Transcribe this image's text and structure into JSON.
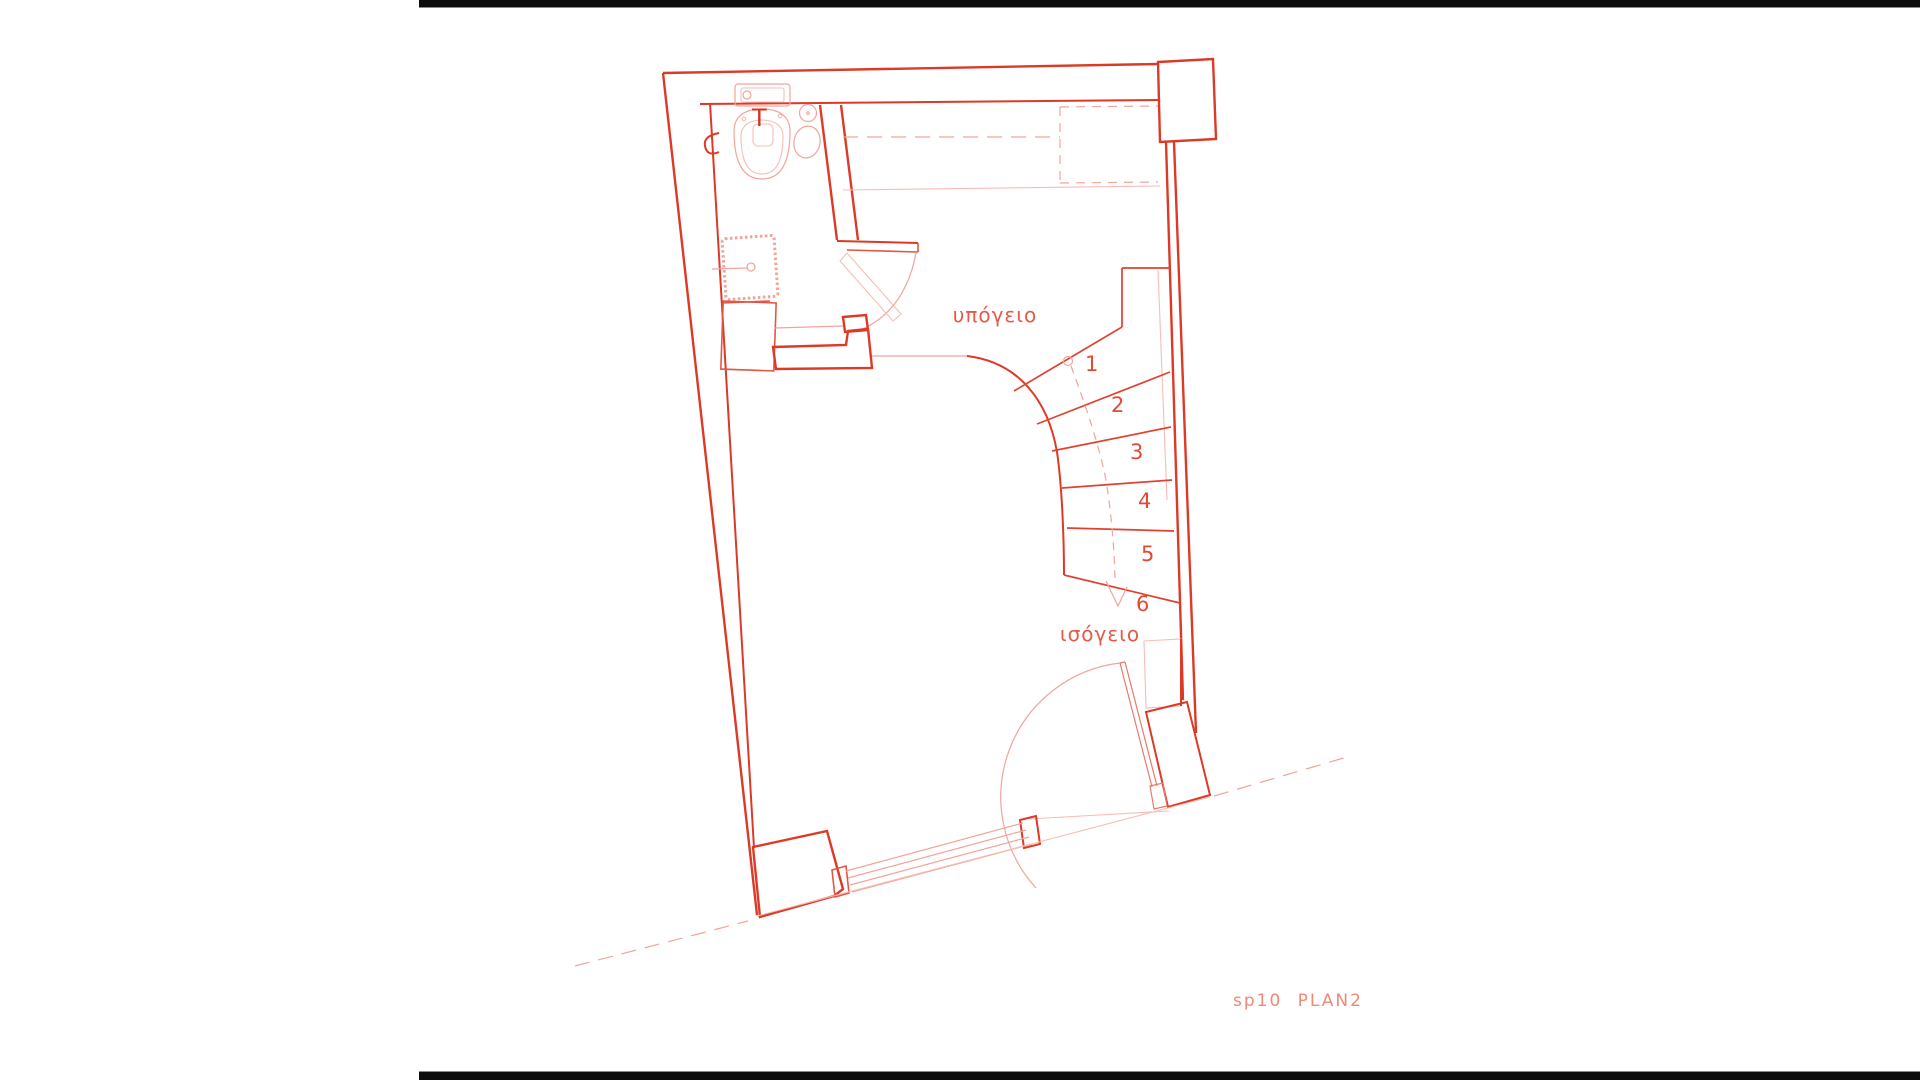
{
  "document": {
    "type": "architectural floor plan scan",
    "background": "#ffffff",
    "frame_bar_color": "#0d0d0d"
  },
  "plan": {
    "labels": {
      "basement": "υπόγειο",
      "ground_floor": "ισόγειο",
      "toilet_mark": "T",
      "drawing_title": "sp10 PLAN2"
    },
    "stairs": {
      "direction": "winder stair, dashed walk line with down arrow",
      "steps": [
        {
          "label": "1"
        },
        {
          "label": "2"
        },
        {
          "label": "3"
        },
        {
          "label": "4"
        },
        {
          "label": "5"
        },
        {
          "label": "6"
        }
      ]
    },
    "colors": {
      "wall_bold": "#dc3a27",
      "line_medium": "#e25743",
      "line_light": "#f2a49a",
      "room_label_text": "#e45b49",
      "title_text": "#ef8878"
    }
  }
}
